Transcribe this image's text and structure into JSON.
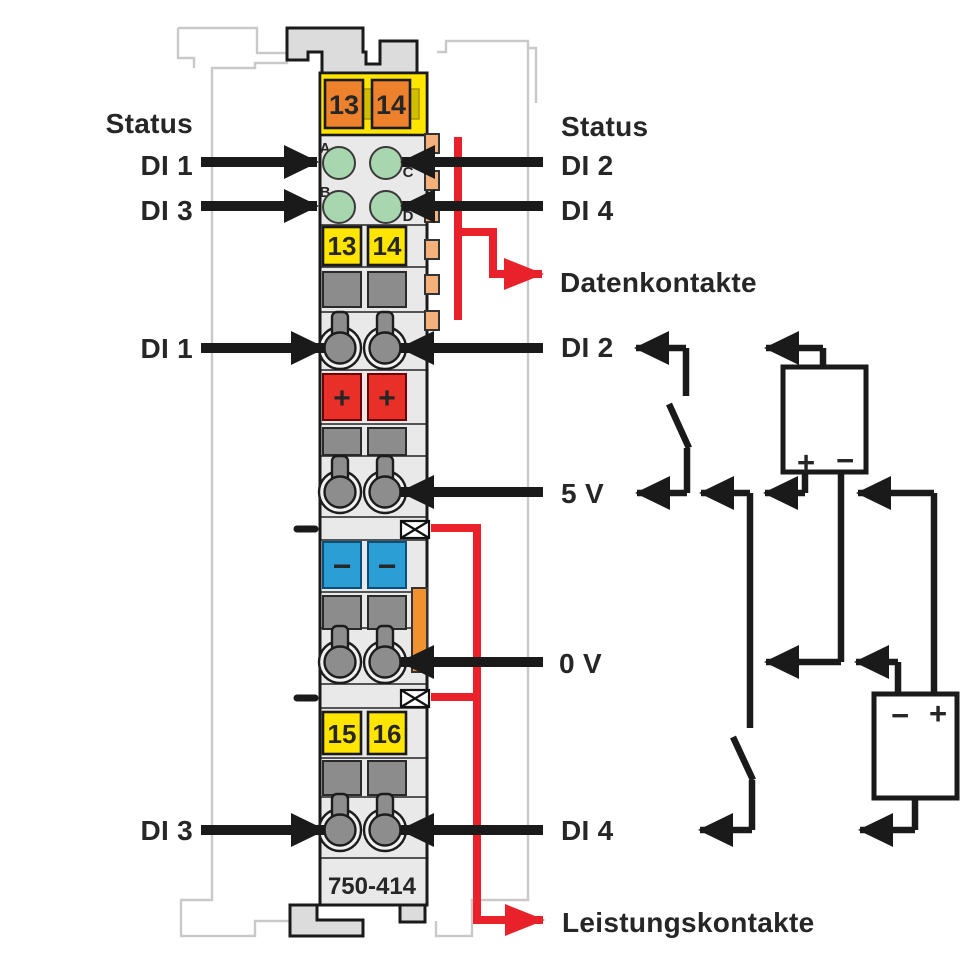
{
  "module": {
    "part_number": "750-414",
    "top_terminals": [
      "13",
      "14"
    ],
    "channel_tags_upper": [
      "13",
      "14"
    ],
    "channel_tags_lower": [
      "15",
      "16"
    ],
    "led_letters": [
      "A",
      "B",
      "C",
      "D"
    ],
    "plus_symbol": "+",
    "minus_symbol": "−"
  },
  "labels": {
    "left": {
      "status": "Status",
      "di1_led": "DI 1",
      "di3_led": "DI 3",
      "di1_input": "DI 1",
      "di3_input": "DI 3"
    },
    "right": {
      "status": "Status",
      "di2_led": "DI 2",
      "di4_led": "DI 4",
      "datenkontakte": "Datenkontakte",
      "di2_input": "DI 2",
      "supply_5v": "5 V",
      "supply_0v": "0 V",
      "di4_input": "DI 4",
      "leistungskontakte": "Leistungskontakte"
    }
  },
  "circuit": {
    "battery_upper": {
      "plus": "+",
      "minus": "−"
    },
    "battery_lower": {
      "minus": "−",
      "plus": "+"
    }
  },
  "colors": {
    "wago_red": "#e8212b",
    "terminal_red": "#e83028",
    "terminal_blue": "#2b9ed6",
    "led_green": "#a8d6af",
    "yellow": "#ffe500",
    "olive_band": "#d2be00",
    "orange": "#ee822c",
    "tab_orange": "#f6b17a",
    "strip_orange": "#f0922f",
    "body_gray": "#e9e9e9",
    "block_gray": "#8c8c8c"
  }
}
